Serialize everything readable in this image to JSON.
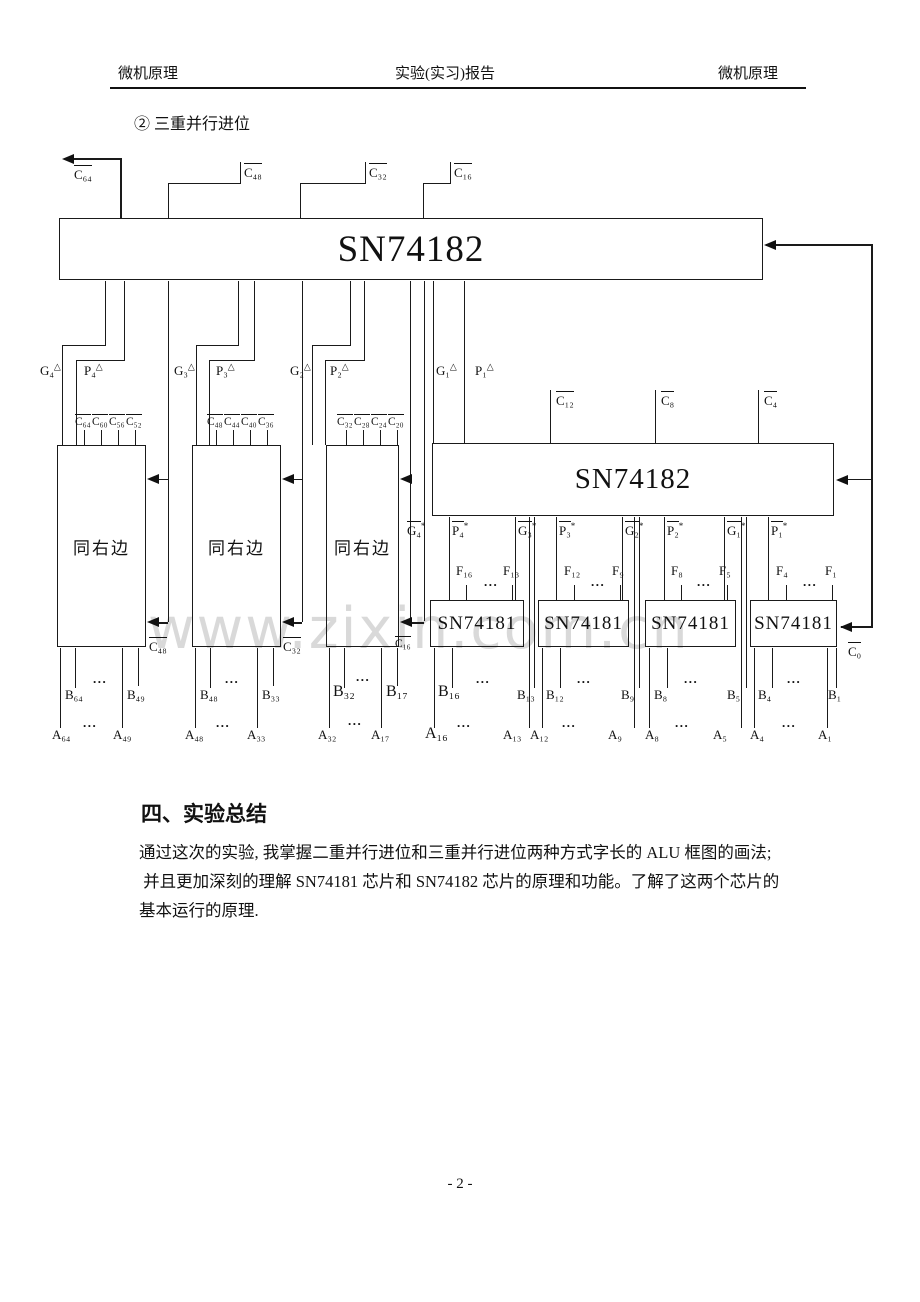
{
  "header": {
    "left": "微机原理",
    "center": "实验(实习)报告",
    "right": "微机原理"
  },
  "subheading": "② 三重并行进位",
  "watermark": "www.zixin.com.cn",
  "chips": {
    "top_label": "SN74182",
    "mid_label": "SN74182",
    "alu_label": "SN74181",
    "same_label": "同右边"
  },
  "dots": "...",
  "signals": {
    "c64": {
      "t": "C₆₄",
      "ov": true
    },
    "c48t": {
      "t": "C₄₈",
      "ov": true
    },
    "c32t": {
      "t": "C₃₂",
      "ov": true
    },
    "c16t": {
      "t": "C₁₆",
      "ov": true
    },
    "g4": {
      "t": "G₄",
      "m": "△"
    },
    "p4": {
      "t": "P₄",
      "m": "△"
    },
    "g3": {
      "t": "G₃",
      "m": "△"
    },
    "p3": {
      "t": "P₃",
      "m": "△"
    },
    "g2": {
      "t": "G₂",
      "m": "△"
    },
    "p2": {
      "t": "P₂",
      "m": "△"
    },
    "g1": {
      "t": "G₁",
      "m": "△"
    },
    "p1": {
      "t": "P₁",
      "m": "△"
    },
    "c64b": {
      "t": "C₆₄",
      "ov": true
    },
    "c60": {
      "t": "C₆₀",
      "ov": true
    },
    "c56": {
      "t": "C₅₆",
      "ov": true
    },
    "c52": {
      "t": "C₅₂",
      "ov": true
    },
    "c48b": {
      "t": "C₄₈",
      "ov": true
    },
    "c44": {
      "t": "C₄₄",
      "ov": true
    },
    "c40": {
      "t": "C₄₀",
      "ov": true
    },
    "c36": {
      "t": "C₃₆",
      "ov": true
    },
    "c32b": {
      "t": "C₃₂",
      "ov": true
    },
    "c28": {
      "t": "C₂₈",
      "ov": true
    },
    "c24": {
      "t": "C₂₄",
      "ov": true
    },
    "c20": {
      "t": "C₂₀",
      "ov": true
    },
    "c12": {
      "t": "C₁₂",
      "ov": true
    },
    "c8": {
      "t": "C₈",
      "ov": true
    },
    "c4": {
      "t": "C₄",
      "ov": true
    },
    "c48a": {
      "t": "C₄₈",
      "ov": true
    },
    "c32a": {
      "t": "C₃₂",
      "ov": true
    },
    "c16a": {
      "t": "C₁₆",
      "ov": true
    },
    "c0": {
      "t": "C₀",
      "ov": true
    },
    "g4s": {
      "t": "G₄",
      "m": "*",
      "ov": true
    },
    "p4s": {
      "t": "P₄",
      "m": "*",
      "ov": true
    },
    "g3s": {
      "t": "G₃",
      "m": "*",
      "ov": true
    },
    "p3s": {
      "t": "P₃",
      "m": "*",
      "ov": true
    },
    "g2s": {
      "t": "G₂",
      "m": "*",
      "ov": true
    },
    "p2s": {
      "t": "P₂",
      "m": "*",
      "ov": true
    },
    "g1s": {
      "t": "G₁",
      "m": "*",
      "ov": true
    },
    "p1s": {
      "t": "P₁",
      "m": "*",
      "ov": true
    },
    "f16": {
      "t": "F₁₆"
    },
    "f13": {
      "t": "F₁₃"
    },
    "f12": {
      "t": "F₁₂"
    },
    "f9": {
      "t": "F₉"
    },
    "f8": {
      "t": "F₈"
    },
    "f5": {
      "t": "F₅"
    },
    "f4": {
      "t": "F₄"
    },
    "f1": {
      "t": "F₁"
    },
    "b64": {
      "t": "B₆₄"
    },
    "b49": {
      "t": "B₄₉"
    },
    "b48": {
      "t": "B₄₈"
    },
    "b33": {
      "t": "B₃₃"
    },
    "b32": {
      "t": "B₃₂"
    },
    "b17": {
      "t": "B₁₇"
    },
    "b16": {
      "t": "B₁₆"
    },
    "b13": {
      "t": "B₁₃"
    },
    "b12": {
      "t": "B₁₂"
    },
    "b9": {
      "t": "B₉"
    },
    "b8": {
      "t": "B₈"
    },
    "b5": {
      "t": "B₅"
    },
    "b4": {
      "t": "B₄"
    },
    "b1": {
      "t": "B₁"
    },
    "a64": {
      "t": "A₆₄"
    },
    "a49": {
      "t": "A₄₉"
    },
    "a48": {
      "t": "A₄₈"
    },
    "a33": {
      "t": "A₃₃"
    },
    "a32": {
      "t": "A₃₂"
    },
    "a17": {
      "t": "A₁₇"
    },
    "a16": {
      "t": "A₁₆"
    },
    "a13": {
      "t": "A₁₃"
    },
    "a12": {
      "t": "A₁₂"
    },
    "a9": {
      "t": "A₉"
    },
    "a8": {
      "t": "A₈"
    },
    "a5": {
      "t": "A₅"
    },
    "a4": {
      "t": "A₄"
    },
    "a1": {
      "t": "A₁"
    }
  },
  "summary": {
    "heading": "四、实验总结",
    "lines": [
      "通过这次的实验, 我掌握二重并行进位和三重并行进位两种方式字长的 ALU 框图的画法;",
      " 并且更加深刻的理解 SN74181 芯片和 SN74182 芯片的原理和功能。了解了这两个芯片的",
      "基本运行的原理."
    ]
  },
  "page_number": "- 2 -"
}
